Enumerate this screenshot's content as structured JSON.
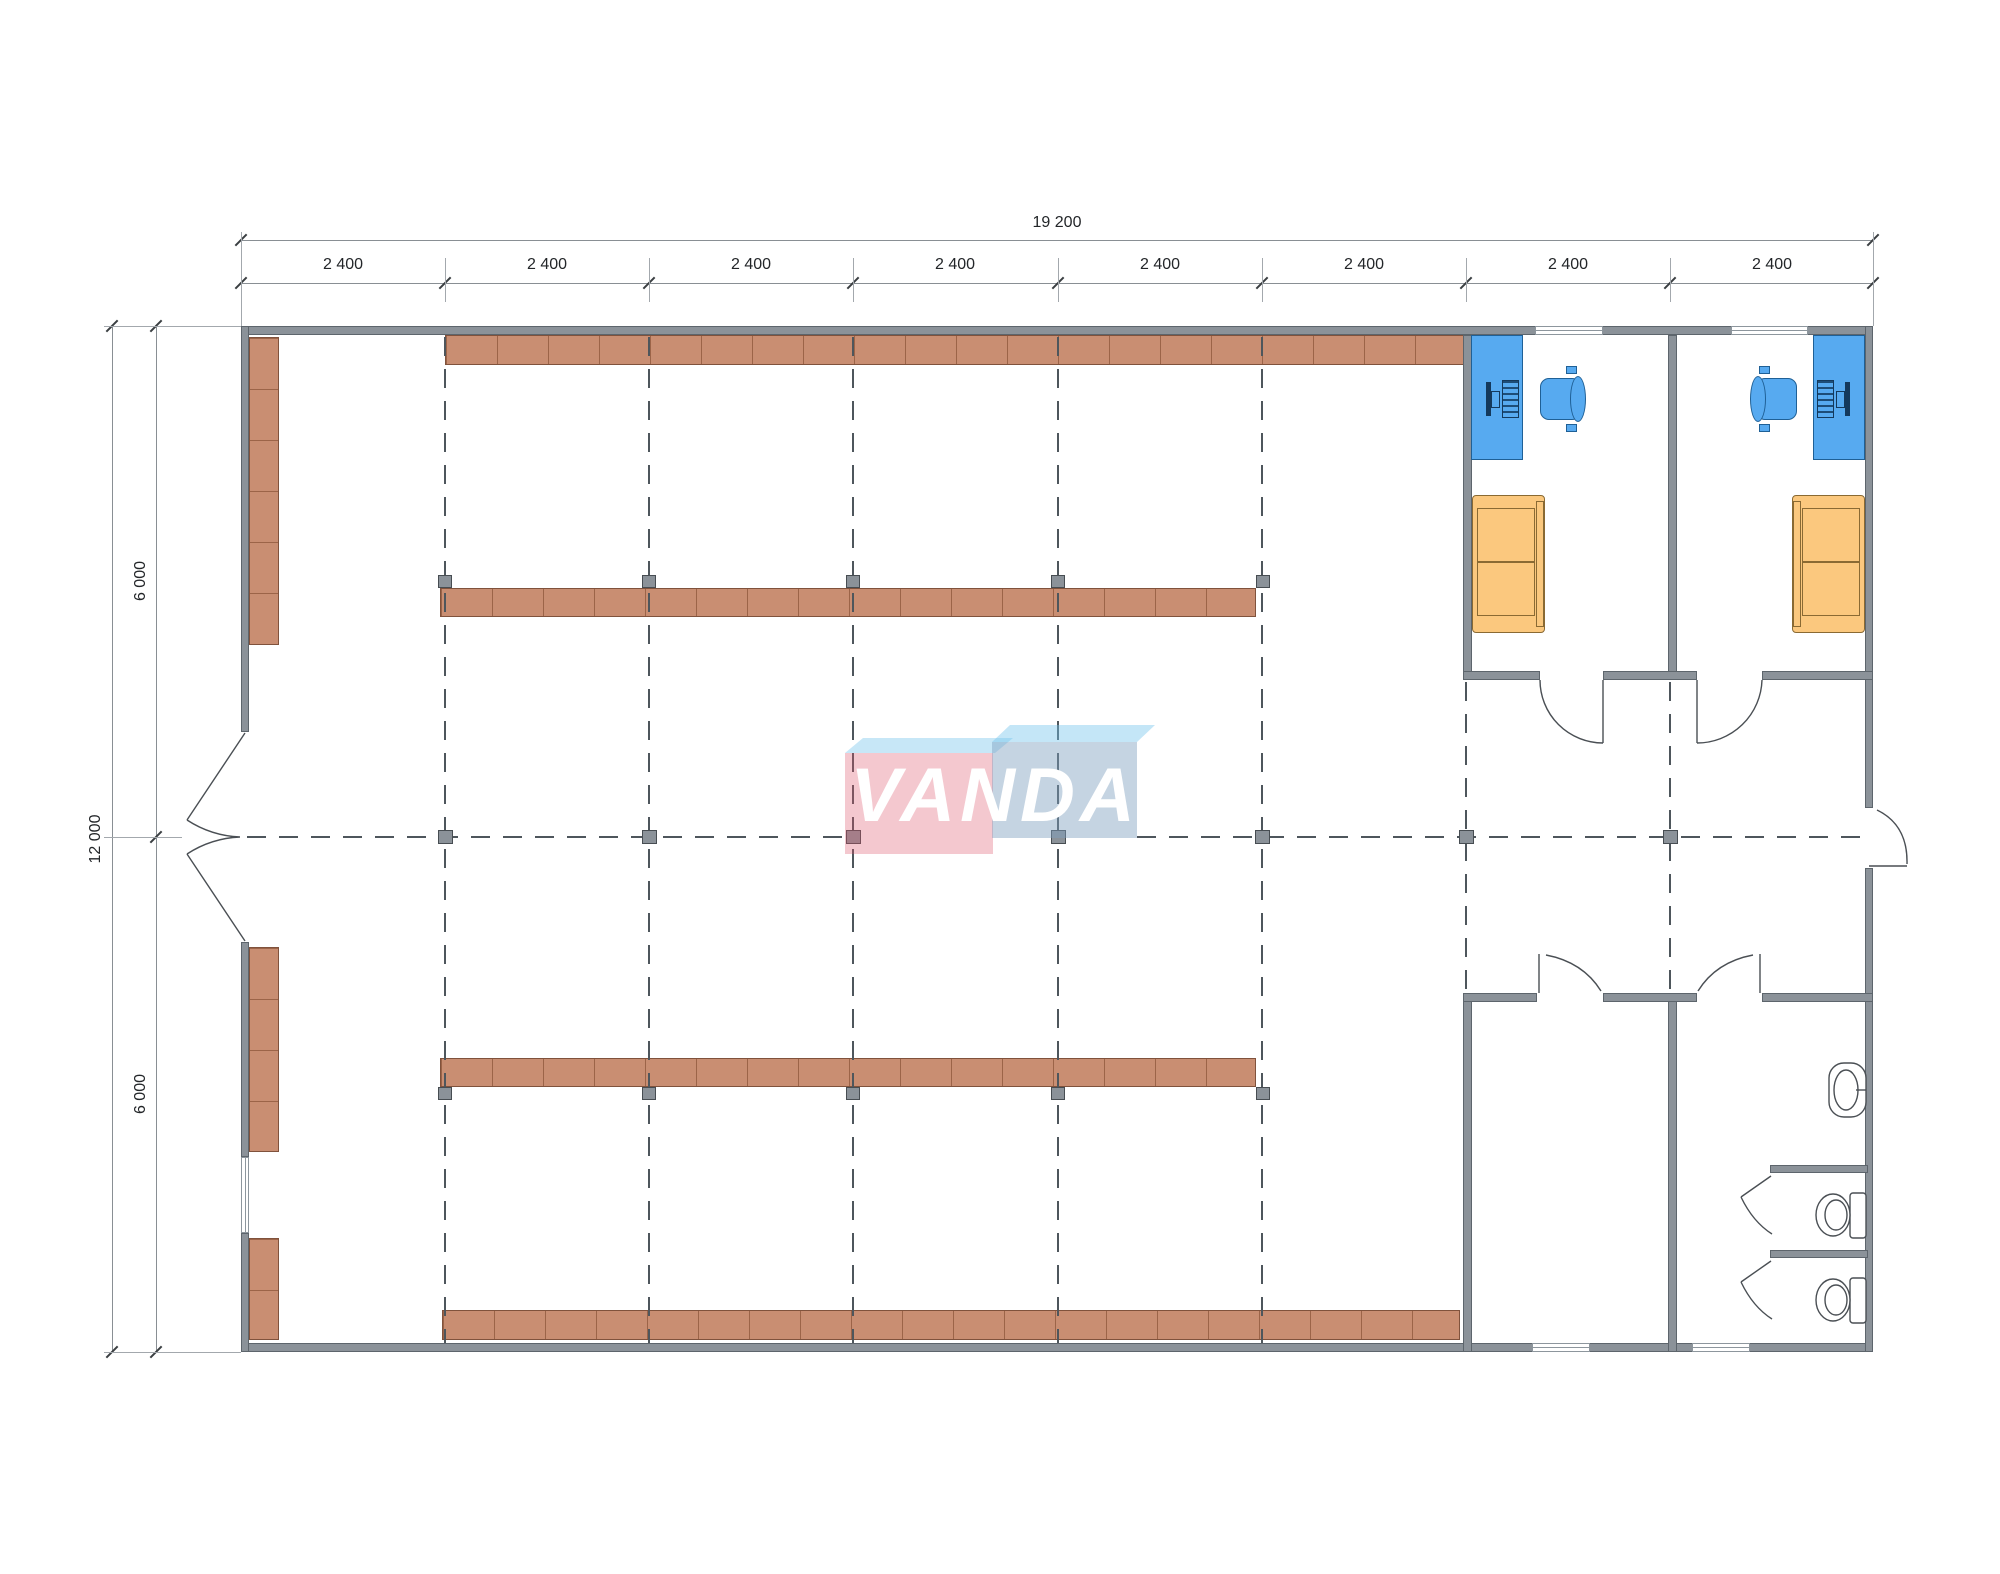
{
  "title": "VANDA retail floor plan",
  "logo": {
    "text": "VANDA",
    "pink_box_color": "#e25569",
    "blue_box_color": "#7ea0bf",
    "flap_color": "#70c0e8"
  },
  "dimensions": {
    "overall_width": "19 200",
    "bay_labels": [
      "2 400",
      "2 400",
      "2 400",
      "2 400",
      "2 400",
      "2 400",
      "2 400",
      "2 400"
    ],
    "overall_height": "12 000",
    "half_height_labels": [
      "6 000",
      "6 000"
    ]
  },
  "colors": {
    "wall": "#8b9299",
    "shelf": "#c98e72",
    "desk_chair_blue": "#57aaf0",
    "sofa_orange": "#fbc87e",
    "grid_dash": "#4e565c"
  }
}
